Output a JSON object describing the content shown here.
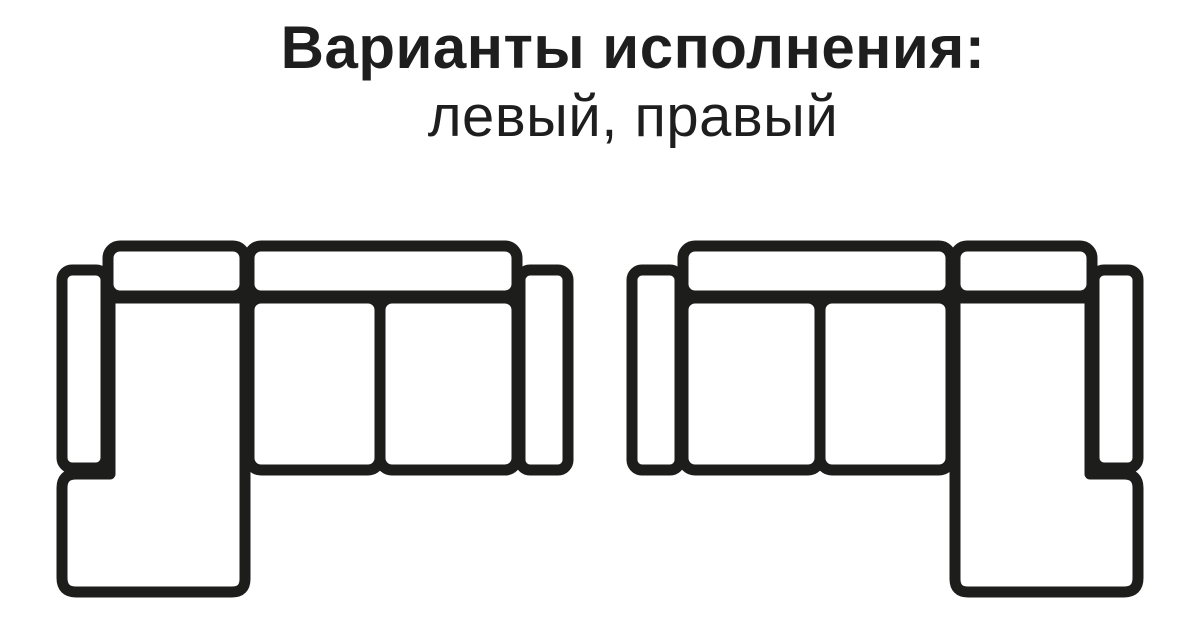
{
  "title": {
    "line1": "Варианты исполнения:",
    "line2": "левый, правый"
  },
  "diagram": {
    "stroke_color": "#1d1d1b",
    "fill_color": "#ffffff",
    "text_color": "#1e1e1e",
    "type": "sofa-configuration-top-view",
    "variants": [
      {
        "name": "левый",
        "chaise_side": "left"
      },
      {
        "name": "правый",
        "chaise_side": "right"
      }
    ],
    "parts": [
      "left-armrest",
      "back-cushion-small",
      "back-cushion-large",
      "seat-cushion-1",
      "seat-cushion-2",
      "chaise-section",
      "right-armrest"
    ]
  }
}
